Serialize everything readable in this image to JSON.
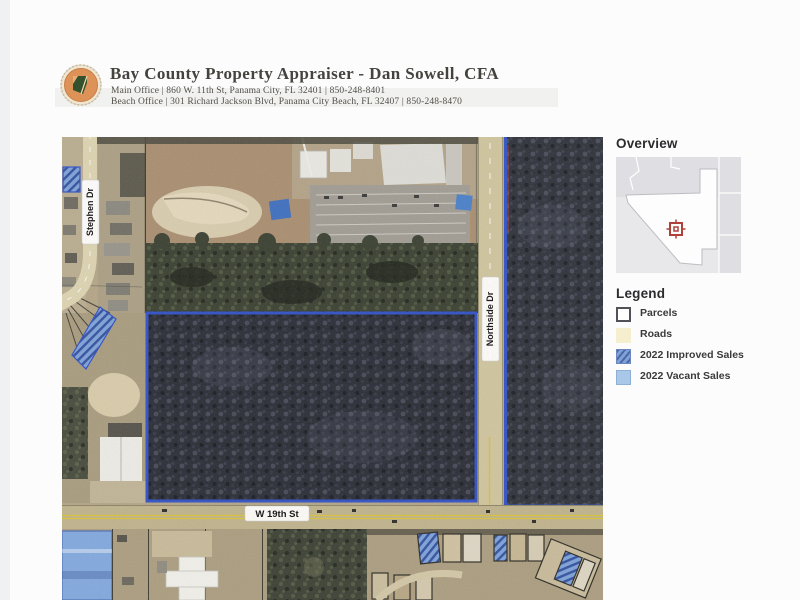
{
  "header": {
    "title": "Bay County Property Appraiser - Dan Sowell, CFA",
    "main_office": "Main Office | 860 W. 11th St, Panama City, FL 32401 | 850-248-8401",
    "beach_office": "Beach Office | 301 Richard Jackson Blvd, Panama City Beach, FL 32407 | 850-248-8470",
    "logo_icon": "bay-county-seal"
  },
  "map": {
    "labels": {
      "stephen_dr": "Stephen Dr",
      "northside_dr": "Northside Dr",
      "w_19th_st": "W 19th St"
    }
  },
  "sidebar": {
    "overview_title": "Overview",
    "marker_icon": "location-crosshair",
    "legend_title": "Legend",
    "legend_items": [
      {
        "label": "Parcels",
        "swatch": "outline",
        "fill": "#ffffff"
      },
      {
        "label": "Roads",
        "swatch": "solid",
        "fill": "#f5efcf"
      },
      {
        "label": "2022 Improved Sales",
        "swatch": "hatched",
        "fill": "#7da2d8"
      },
      {
        "label": "2022 Vacant Sales",
        "swatch": "solid",
        "fill": "#a9c7e9"
      }
    ]
  },
  "colors": {
    "parcel_boundary": "#3151c5",
    "improved_sales": "#7da2d8",
    "vacant_sales": "#82a8dd",
    "marker_red": "#b04038"
  }
}
